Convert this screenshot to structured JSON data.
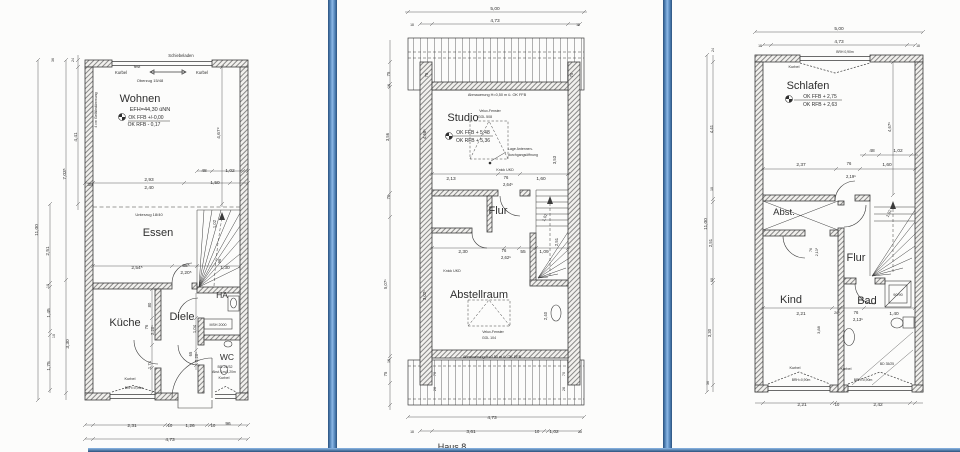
{
  "colors": {
    "paper": "#fcfcfb",
    "ink": "#2f2f2f",
    "line": "#4a4a4a",
    "divider_dark": "#2c517c",
    "divider_mid": "#4d7fb4",
    "divider_light": "#8cb8e6"
  },
  "texts": [
    {
      "n": "eg-label-schiebeladen",
      "t": "Schiebeladen",
      "x": 181,
      "y": 57,
      "s": 4.2
    },
    {
      "n": "eg-label-kurbel-left",
      "t": "Kurbel",
      "x": 121,
      "y": 74,
      "s": 4.2
    },
    {
      "n": "eg-label-fest",
      "t": "fest",
      "x": 137,
      "y": 68,
      "s": 4
    },
    {
      "n": "eg-label-kurbel-right",
      "t": "Kurbel",
      "x": 202,
      "y": 74,
      "s": 4.2
    },
    {
      "n": "eg-label-oberzug",
      "t": "Oberzug 15/48",
      "x": 150,
      "y": 82,
      "s": 4
    },
    {
      "n": "eg-room-wohnen",
      "t": "Wohnen",
      "x": 140,
      "y": 102,
      "s": 11
    },
    {
      "n": "eg-level-efh",
      "t": "EFH=44,30 üNN",
      "x": 150,
      "y": 111,
      "s": 5.5
    },
    {
      "n": "eg-level-okffb",
      "t": "OK FFB +/-0,00",
      "x": 146,
      "y": 119,
      "s": 5
    },
    {
      "n": "eg-level-okrfb",
      "t": "OK RFB  -  0,17",
      "x": 144,
      "y": 126,
      "s": 5
    },
    {
      "n": "eg-note-gefaelle",
      "t": "4 cm Gefälledämmung",
      "x": 97,
      "y": 110,
      "s": 3.5,
      "r": -90
    },
    {
      "n": "eg-dim-4679",
      "t": "4,67⁹",
      "x": 220,
      "y": 133,
      "s": 4.8,
      "r": -90
    },
    {
      "n": "eg-dim-30",
      "t": "30",
      "x": 90,
      "y": 186,
      "s": 4.8
    },
    {
      "n": "eg-dim-293",
      "t": "2,93",
      "x": 149,
      "y": 181,
      "s": 4.8
    },
    {
      "n": "eg-dim-240",
      "t": "2,40",
      "x": 149,
      "y": 189,
      "s": 4.8
    },
    {
      "n": "eg-dim-48",
      "t": "48",
      "x": 204,
      "y": 172,
      "s": 4.8
    },
    {
      "n": "eg-dim-102",
      "t": "1,02",
      "x": 230,
      "y": 172,
      "s": 4.8
    },
    {
      "n": "eg-dim-150",
      "t": "1,50",
      "x": 215,
      "y": 184,
      "s": 4.8
    },
    {
      "n": "eg-note-unterzug",
      "t": "Unterzug 18/40",
      "x": 149,
      "y": 216,
      "s": 4
    },
    {
      "n": "eg-room-essen",
      "t": "Essen",
      "x": 158,
      "y": 236,
      "s": 11
    },
    {
      "n": "eg-dim-102-stair",
      "t": "1,02",
      "x": 216,
      "y": 224,
      "s": 4.2,
      "r": -90
    },
    {
      "n": "eg-dim-96-stair",
      "t": "96",
      "x": 221,
      "y": 261,
      "s": 4.2,
      "r": -90
    },
    {
      "n": "eg-dim-254",
      "t": "2,54⁵",
      "x": 137,
      "y": 269,
      "s": 4.8
    },
    {
      "n": "eg-dim-88",
      "t": "88⁵",
      "x": 186,
      "y": 267,
      "s": 4.8
    },
    {
      "n": "eg-dim-220",
      "t": "2,20⁵",
      "x": 186,
      "y": 274,
      "s": 4.8
    },
    {
      "n": "eg-dim-130",
      "t": "1,30",
      "x": 225,
      "y": 269,
      "s": 4.8
    },
    {
      "n": "eg-room-ha",
      "t": "HA",
      "x": 222,
      "y": 298,
      "s": 8.5
    },
    {
      "n": "eg-room-kueche",
      "t": "Küche",
      "x": 125,
      "y": 326,
      "s": 11
    },
    {
      "n": "eg-room-diele",
      "t": "Diele",
      "x": 182,
      "y": 320,
      "s": 11
    },
    {
      "n": "eg-dim-80",
      "t": "80",
      "x": 151,
      "y": 305,
      "s": 4.2,
      "r": -90
    },
    {
      "n": "eg-dim-76-door",
      "t": "76",
      "x": 148,
      "y": 327,
      "s": 4.2,
      "r": -90
    },
    {
      "n": "eg-dim-220-door",
      "t": "2,20⁵",
      "x": 154,
      "y": 330,
      "s": 4.2,
      "r": -90
    },
    {
      "n": "eg-dim-104",
      "t": "1,04",
      "x": 196,
      "y": 329,
      "s": 4.2,
      "r": -90
    },
    {
      "n": "eg-dim-174",
      "t": "1,74",
      "x": 151,
      "y": 365,
      "s": 4.2,
      "r": -90
    },
    {
      "n": "eg-dim-65-door",
      "t": "65",
      "x": 192,
      "y": 354,
      "s": 4.2,
      "r": -90
    },
    {
      "n": "eg-dim-220b-door",
      "t": "2,20⁵",
      "x": 198,
      "y": 357,
      "s": 4.2,
      "r": -90
    },
    {
      "n": "eg-note-msh",
      "t": "MSH 2000",
      "x": 218,
      "y": 326,
      "s": 3.6
    },
    {
      "n": "eg-room-wc",
      "t": "WC",
      "x": 227,
      "y": 360,
      "s": 8.5
    },
    {
      "n": "eg-note-bd",
      "t": "BD 25/32",
      "x": 225,
      "y": 368,
      "s": 3.6
    },
    {
      "n": "eg-note-abst",
      "t": "Abst. 1m/1,20m",
      "x": 224,
      "y": 373,
      "s": 3.4
    },
    {
      "n": "eg-label-kurbel-wc",
      "t": "Kurbel",
      "x": 224,
      "y": 379,
      "s": 3.8
    },
    {
      "n": "eg-label-kurbel-kueche",
      "t": "Kurbel",
      "x": 130,
      "y": 380,
      "s": 3.8
    },
    {
      "n": "eg-note-brh-kueche",
      "t": "BRH=0,90m",
      "x": 134,
      "y": 389,
      "s": 3.4
    },
    {
      "n": "eg-dim-1100",
      "t": "11,00",
      "x": 38,
      "y": 230,
      "s": 4.8,
      "r": -90
    },
    {
      "n": "eg-dim-703",
      "t": "7,03⁵",
      "x": 66,
      "y": 174,
      "s": 4.8,
      "r": -90
    },
    {
      "n": "eg-dim-330",
      "t": "3,30",
      "x": 69,
      "y": 344,
      "s": 4.8,
      "r": -90
    },
    {
      "n": "eg-dim-441",
      "t": "4,41",
      "x": 77,
      "y": 137,
      "s": 4.8,
      "r": -90
    },
    {
      "n": "eg-dim-36-top",
      "t": "36",
      "x": 54,
      "y": 60,
      "s": 3.6,
      "r": -90
    },
    {
      "n": "eg-dim-24-top",
      "t": "24",
      "x": 74,
      "y": 60,
      "s": 3.6,
      "r": -90
    },
    {
      "n": "eg-dim-251",
      "t": "2,51",
      "x": 49,
      "y": 251,
      "s": 4.8,
      "r": -90
    },
    {
      "n": "eg-dim-10a",
      "t": "10",
      "x": 49,
      "y": 286,
      "s": 3.8,
      "r": -90
    },
    {
      "n": "eg-dim-145",
      "t": "1,45",
      "x": 50,
      "y": 313,
      "s": 4.8,
      "r": -90
    },
    {
      "n": "eg-dim-10b",
      "t": "10",
      "x": 55,
      "y": 336,
      "s": 3.8,
      "r": -90
    },
    {
      "n": "eg-dim-175",
      "t": "1,75",
      "x": 50,
      "y": 366,
      "s": 4.8,
      "r": -90
    },
    {
      "n": "eg-dim-231",
      "t": "2,31",
      "x": 132,
      "y": 427,
      "s": 4.8
    },
    {
      "n": "eg-dim-10c",
      "t": "10",
      "x": 170,
      "y": 427,
      "s": 4.2
    },
    {
      "n": "eg-dim-126",
      "t": "1,26",
      "x": 190,
      "y": 427,
      "s": 4.8
    },
    {
      "n": "eg-dim-10d",
      "t": "10",
      "x": 213,
      "y": 427,
      "s": 4.2
    },
    {
      "n": "eg-dim-96",
      "t": "96",
      "x": 228,
      "y": 425,
      "s": 4.8
    },
    {
      "n": "eg-dim-473",
      "t": "4,73",
      "x": 170,
      "y": 441,
      "s": 4.8
    },
    {
      "n": "dg-dim-500",
      "t": "5,00",
      "x": 495,
      "y": 10,
      "s": 4.8
    },
    {
      "n": "dg-dim-473-top",
      "t": "4,73",
      "x": 495,
      "y": 22,
      "s": 4.8
    },
    {
      "n": "dg-mark-18-tl",
      "t": "18",
      "x": 412,
      "y": 26,
      "s": 3.4
    },
    {
      "n": "dg-mark-18-tr",
      "t": "18",
      "x": 578,
      "y": 26,
      "s": 3.4
    },
    {
      "n": "dg-dim-75-tl",
      "t": "75",
      "x": 428,
      "y": 75,
      "s": 4.2,
      "r": -90
    },
    {
      "n": "dg-dim-75-tr",
      "t": "75",
      "x": 573,
      "y": 75,
      "s": 4.2,
      "r": -90
    },
    {
      "n": "dg-note-abmauerung-top",
      "t": "Abmauerung H=0,50 m ü. OK FFB",
      "x": 497,
      "y": 96,
      "s": 3.8
    },
    {
      "n": "dg-room-studio",
      "t": "Studio",
      "x": 463,
      "y": 121,
      "s": 11
    },
    {
      "n": "dg-note-velux1a",
      "t": "Velux-Fenster",
      "x": 490,
      "y": 112,
      "s": 3.5
    },
    {
      "n": "dg-note-velux1b",
      "t": "GGL 508",
      "x": 485,
      "y": 118,
      "s": 3.5
    },
    {
      "n": "dg-level-okffb",
      "t": "OK FFB + 5,48",
      "x": 473,
      "y": 134,
      "s": 5
    },
    {
      "n": "dg-level-okrfb",
      "t": "OK RFB + 5,36",
      "x": 473,
      "y": 142,
      "s": 5
    },
    {
      "n": "dg-note-antenne1",
      "t": "Lage Antennen-",
      "x": 508,
      "y": 150,
      "s": 3.5,
      "a": "s"
    },
    {
      "n": "dg-note-antenne2",
      "t": "durchgangsöffnung",
      "x": 508,
      "y": 156,
      "s": 3.5,
      "a": "s"
    },
    {
      "n": "dg-dim-468",
      "t": "4,68⁵",
      "x": 426,
      "y": 134,
      "s": 4.2,
      "r": -90
    },
    {
      "n": "dg-dim-353",
      "t": "3,53",
      "x": 556,
      "y": 160,
      "s": 4.2,
      "r": -90
    },
    {
      "n": "dg-note-knick1",
      "t": "Knick UKD",
      "x": 505,
      "y": 171,
      "s": 3.6
    },
    {
      "n": "dg-dim-213",
      "t": "2,13",
      "x": 451,
      "y": 180,
      "s": 4.8
    },
    {
      "n": "dg-dim-76a",
      "t": "76",
      "x": 506,
      "y": 179,
      "s": 4.2
    },
    {
      "n": "dg-dim-264",
      "t": "2,64⁵",
      "x": 508,
      "y": 186,
      "s": 4.2
    },
    {
      "n": "dg-dim-160",
      "t": "1,60",
      "x": 541,
      "y": 180,
      "s": 4.8
    },
    {
      "n": "dg-room-flur",
      "t": "Flur",
      "x": 498,
      "y": 214,
      "s": 11
    },
    {
      "n": "dg-dim-102-stair",
      "t": "1,02",
      "x": 546,
      "y": 218,
      "s": 4,
      "r": -70
    },
    {
      "n": "dg-dim-251-stair",
      "t": "2,51",
      "x": 558,
      "y": 242,
      "s": 4.2,
      "r": -90
    },
    {
      "n": "dg-dim-230",
      "t": "2,30",
      "x": 463,
      "y": 253,
      "s": 4.8
    },
    {
      "n": "dg-dim-76b",
      "t": "76",
      "x": 504,
      "y": 252,
      "s": 4.2
    },
    {
      "n": "dg-dim-262",
      "t": "2,62⁵",
      "x": 506,
      "y": 259,
      "s": 4.2
    },
    {
      "n": "dg-dim-55",
      "t": "55",
      "x": 523,
      "y": 253,
      "s": 4.8
    },
    {
      "n": "dg-dim-109",
      "t": "1,09",
      "x": 544,
      "y": 253,
      "s": 4.8
    },
    {
      "n": "dg-note-knick2",
      "t": "Knick UKD",
      "x": 452,
      "y": 272,
      "s": 3.6
    },
    {
      "n": "dg-room-abstellraum",
      "t": "Abstellraum",
      "x": 479,
      "y": 298,
      "s": 11
    },
    {
      "n": "dg-dim-302",
      "t": "3,02⁵",
      "x": 426,
      "y": 295,
      "s": 4.2,
      "r": -90
    },
    {
      "n": "dg-note-velux2a",
      "t": "Velux-Fenster",
      "x": 493,
      "y": 333,
      "s": 3.5
    },
    {
      "n": "dg-note-velux2b",
      "t": "GGL 104",
      "x": 489,
      "y": 339,
      "s": 3.5
    },
    {
      "n": "dg-dim-240",
      "t": "2,40",
      "x": 547,
      "y": 316,
      "s": 4.2,
      "r": -90
    },
    {
      "n": "dg-note-abmauerung-bottom",
      "t": "Abmauerung H=0,50 m ü. OK FFB",
      "x": 492,
      "y": 358,
      "s": 3.8
    },
    {
      "n": "dg-dim-70-bl",
      "t": "70",
      "x": 436,
      "y": 374,
      "s": 3.8,
      "r": -90
    },
    {
      "n": "dg-dim-26-bl",
      "t": "26",
      "x": 436,
      "y": 389,
      "s": 3.8,
      "r": -90
    },
    {
      "n": "dg-dim-70-br",
      "t": "70",
      "x": 565,
      "y": 374,
      "s": 3.8,
      "r": -90
    },
    {
      "n": "dg-dim-26-br",
      "t": "26",
      "x": 565,
      "y": 389,
      "s": 3.8,
      "r": -90
    },
    {
      "n": "dg-dim-75-l1",
      "t": "75",
      "x": 390,
      "y": 74,
      "s": 4.2,
      "r": -90
    },
    {
      "n": "dg-dim-10-l1",
      "t": "10",
      "x": 390,
      "y": 86,
      "s": 3.6,
      "r": -90
    },
    {
      "n": "dg-dim-356",
      "t": "3,56",
      "x": 389,
      "y": 137,
      "s": 4.2,
      "r": -90
    },
    {
      "n": "dg-dim-76-l",
      "t": "76",
      "x": 390,
      "y": 197,
      "s": 4.2,
      "r": -90
    },
    {
      "n": "dg-dim-507",
      "t": "5,07⁵",
      "x": 387,
      "y": 284,
      "s": 4.2,
      "r": -90
    },
    {
      "n": "dg-dim-10-l2",
      "t": "10",
      "x": 390,
      "y": 361,
      "s": 3.6,
      "r": -90
    },
    {
      "n": "dg-dim-75-l2",
      "t": "75",
      "x": 387,
      "y": 374,
      "s": 4.2,
      "r": -90
    },
    {
      "n": "dg-dim-473-bottom",
      "t": "4,73",
      "x": 492,
      "y": 419,
      "s": 4.8
    },
    {
      "n": "dg-dim-361",
      "t": "3,61",
      "x": 471,
      "y": 433,
      "s": 4.8
    },
    {
      "n": "dg-dim-10-b",
      "t": "10",
      "x": 537,
      "y": 433,
      "s": 4.2
    },
    {
      "n": "dg-dim-102-b",
      "t": "1,02",
      "x": 554,
      "y": 433,
      "s": 4.8
    },
    {
      "n": "dg-mark-18-bl",
      "t": "18",
      "x": 412,
      "y": 433,
      "s": 3.4
    },
    {
      "n": "dg-mark-18-br",
      "t": "18",
      "x": 580,
      "y": 433,
      "s": 3.4
    },
    {
      "n": "dg-caption-haus8",
      "t": "Haus 8",
      "x": 452,
      "y": 450,
      "s": 9
    },
    {
      "n": "og-dim-500",
      "t": "5,00",
      "x": 839,
      "y": 30,
      "s": 4.8
    },
    {
      "n": "og-dim-473",
      "t": "4,73",
      "x": 839,
      "y": 43,
      "s": 4.8
    },
    {
      "n": "og-mark-18-tl",
      "t": "18",
      "x": 760,
      "y": 47,
      "s": 3.4
    },
    {
      "n": "og-mark-18-tr",
      "t": "18",
      "x": 918,
      "y": 47,
      "s": 3.4
    },
    {
      "n": "og-label-kurbel-top",
      "t": "Kurbel",
      "x": 794,
      "y": 68,
      "s": 3.8
    },
    {
      "n": "og-note-brh-top",
      "t": "BRH 0,90m",
      "x": 845,
      "y": 53,
      "s": 3.4
    },
    {
      "n": "og-room-schlafen",
      "t": "Schlafen",
      "x": 808,
      "y": 89,
      "s": 11
    },
    {
      "n": "og-level-okffb",
      "t": "OK FFB + 2,75",
      "x": 820,
      "y": 98,
      "s": 5
    },
    {
      "n": "og-level-okrfb",
      "t": "OK RFB + 2,63",
      "x": 820,
      "y": 106,
      "s": 5
    },
    {
      "n": "og-dim-4679",
      "t": "4,67⁹",
      "x": 891,
      "y": 127,
      "s": 4.2,
      "r": -90
    },
    {
      "n": "og-dim-1100",
      "t": "11,00",
      "x": 707,
      "y": 224,
      "s": 4.8,
      "r": -90
    },
    {
      "n": "og-dim-24-top",
      "t": "24",
      "x": 714,
      "y": 50,
      "s": 3.6,
      "r": -90
    },
    {
      "n": "og-dim-441",
      "t": "4,41",
      "x": 713,
      "y": 129,
      "s": 4.2,
      "r": -90
    },
    {
      "n": "og-dim-10a",
      "t": "10",
      "x": 713,
      "y": 189,
      "s": 3.6,
      "r": -90
    },
    {
      "n": "og-dim-251",
      "t": "2,51",
      "x": 712,
      "y": 243,
      "s": 4.2,
      "r": -90
    },
    {
      "n": "og-dim-10b",
      "t": "10",
      "x": 713,
      "y": 280,
      "s": 3.6,
      "r": -90
    },
    {
      "n": "og-dim-330",
      "t": "3,30",
      "x": 711,
      "y": 333,
      "s": 4.2,
      "r": -90
    },
    {
      "n": "og-dim-36-bottom",
      "t": "36",
      "x": 709,
      "y": 383,
      "s": 3.6,
      "r": -90
    },
    {
      "n": "og-dim-48",
      "t": "48",
      "x": 872,
      "y": 152,
      "s": 4.8
    },
    {
      "n": "og-dim-102",
      "t": "1,02",
      "x": 898,
      "y": 152,
      "s": 4.8
    },
    {
      "n": "og-dim-237",
      "t": "2,37",
      "x": 801,
      "y": 166,
      "s": 4.8
    },
    {
      "n": "og-dim-76a",
      "t": "76",
      "x": 849,
      "y": 165,
      "s": 4.2
    },
    {
      "n": "og-dim-219",
      "t": "2,19⁵",
      "x": 851,
      "y": 178,
      "s": 4.2
    },
    {
      "n": "og-dim-160",
      "t": "1,60",
      "x": 887,
      "y": 166,
      "s": 4.8
    },
    {
      "n": "og-room-abst",
      "t": "Abst.",
      "x": 784,
      "y": 215,
      "s": 9.5
    },
    {
      "n": "og-dim-76-rot",
      "t": "76",
      "x": 812,
      "y": 250,
      "s": 3.6,
      "r": -90
    },
    {
      "n": "og-dim-213-rot",
      "t": "2,13⁵",
      "x": 818,
      "y": 252,
      "s": 3.6,
      "r": -90
    },
    {
      "n": "og-room-flur",
      "t": "Flur",
      "x": 856,
      "y": 261,
      "s": 11
    },
    {
      "n": "og-dim-102-stair",
      "t": "1,02",
      "x": 890,
      "y": 214,
      "s": 4,
      "r": -65
    },
    {
      "n": "og-room-kind",
      "t": "Kind",
      "x": 791,
      "y": 303,
      "s": 11
    },
    {
      "n": "og-dim-221a",
      "t": "2,21",
      "x": 801,
      "y": 315,
      "s": 4.8
    },
    {
      "n": "og-dim-26",
      "t": "26⁵",
      "x": 837,
      "y": 314,
      "s": 3.8
    },
    {
      "n": "og-dim-76b",
      "t": "76",
      "x": 856,
      "y": 314,
      "s": 4.2
    },
    {
      "n": "og-dim-213-door",
      "t": "2,13⁵",
      "x": 858,
      "y": 321,
      "s": 4.2
    },
    {
      "n": "og-dim-140",
      "t": "1,40",
      "x": 894,
      "y": 315,
      "s": 4.8
    },
    {
      "n": "og-dim-388",
      "t": "3,88",
      "x": 820,
      "y": 330,
      "s": 4,
      "r": -90
    },
    {
      "n": "og-room-bad",
      "t": "Bad",
      "x": 867,
      "y": 304,
      "s": 11
    },
    {
      "n": "og-note-shower",
      "t": "90/90",
      "x": 898,
      "y": 296,
      "s": 3.8
    },
    {
      "n": "og-note-bd",
      "t": "BD 35/25",
      "x": 887,
      "y": 365,
      "s": 3.4
    },
    {
      "n": "og-label-kurbel-kind",
      "t": "Kurbel",
      "x": 795,
      "y": 369,
      "s": 3.8
    },
    {
      "n": "og-note-brh-kind",
      "t": "BRH=0,90m",
      "x": 801,
      "y": 381,
      "s": 3.4
    },
    {
      "n": "og-label-kurbel-bad",
      "t": "Kurbel",
      "x": 846,
      "y": 370,
      "s": 3.8
    },
    {
      "n": "og-note-brh-bad",
      "t": "BRH=0,90m",
      "x": 863,
      "y": 381,
      "s": 3.4
    },
    {
      "n": "og-dim-221b",
      "t": "2,21",
      "x": 802,
      "y": 406,
      "s": 4.8
    },
    {
      "n": "og-dim-10c",
      "t": "10",
      "x": 837,
      "y": 406,
      "s": 4.2
    },
    {
      "n": "og-dim-242",
      "t": "2,42",
      "x": 878,
      "y": 406,
      "s": 4.8
    }
  ]
}
